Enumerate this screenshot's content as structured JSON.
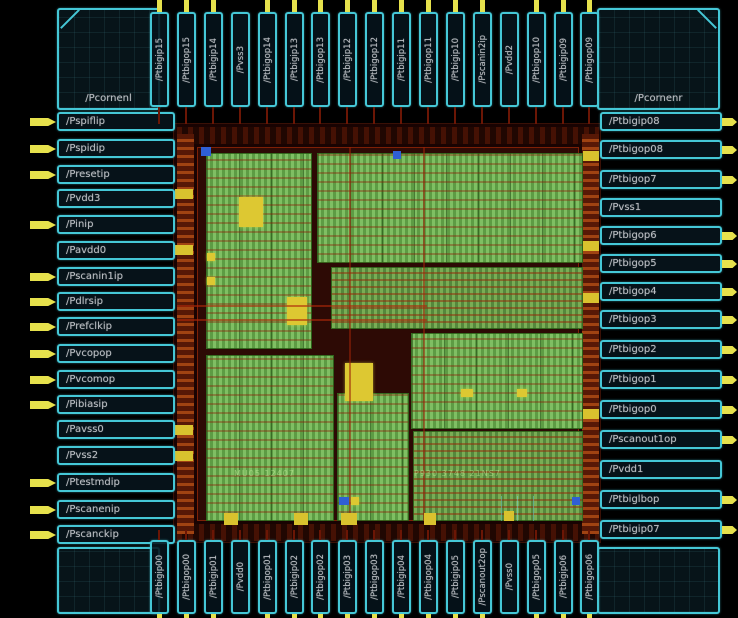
{
  "app": {
    "title": "IC layout viewer - chip pad ring and die"
  },
  "pads": {
    "corner_tl": {
      "label": "/Pcornenl"
    },
    "corner_tr": {
      "label": "/Pcornenr"
    },
    "left": [
      {
        "label": "/Pspiflip",
        "pin": true
      },
      {
        "label": "/Pspidip",
        "pin": true
      },
      {
        "label": "/Presetip",
        "pin": true
      },
      {
        "label": "/Pvdd3",
        "pin": false
      },
      {
        "label": "/Pinip",
        "pin": true
      },
      {
        "label": "/Pavdd0",
        "pin": false
      },
      {
        "label": "/Pscanin1ip",
        "pin": true
      },
      {
        "label": "/Pdlrsip",
        "pin": true
      },
      {
        "label": "/Prefclkip",
        "pin": true
      },
      {
        "label": "/Pvcopop",
        "pin": true
      },
      {
        "label": "/Pvcomop",
        "pin": true
      },
      {
        "label": "/Pibiasip",
        "pin": true
      },
      {
        "label": "/Pavss0",
        "pin": false
      },
      {
        "label": "/Pvss2",
        "pin": false
      },
      {
        "label": "/Ptestmdip",
        "pin": true
      },
      {
        "label": "/Pscanenip",
        "pin": true
      },
      {
        "label": "/Pscanckip",
        "pin": true
      }
    ],
    "right": [
      {
        "label": "/Ptbigip08",
        "pin": true
      },
      {
        "label": "/Ptbigop08",
        "pin": true
      },
      {
        "label": "/Ptbigop7",
        "pin": true
      },
      {
        "label": "/Pvss1",
        "pin": false
      },
      {
        "label": "/Ptbigop6",
        "pin": true
      },
      {
        "label": "/Ptbigop5",
        "pin": true
      },
      {
        "label": "/Ptbigop4",
        "pin": true
      },
      {
        "label": "/Ptbigop3",
        "pin": true
      },
      {
        "label": "/Ptbigop2",
        "pin": true
      },
      {
        "label": "/Ptbigop1",
        "pin": true
      },
      {
        "label": "/Ptbigop0",
        "pin": true
      },
      {
        "label": "/Pscanout1op",
        "pin": true
      },
      {
        "label": "/Pvdd1",
        "pin": false
      },
      {
        "label": "/Ptbiglbop",
        "pin": true
      },
      {
        "label": "/Ptbigip07",
        "pin": true
      }
    ],
    "top": [
      {
        "label": "/Ptbigip15",
        "pin": true
      },
      {
        "label": "/Ptbigop15",
        "pin": true
      },
      {
        "label": "/Ptbigip14",
        "pin": true
      },
      {
        "label": "/Pvss3",
        "pin": false
      },
      {
        "label": "/Ptbigop14",
        "pin": true
      },
      {
        "label": "/Ptbigip13",
        "pin": true
      },
      {
        "label": "/Ptbigop13",
        "pin": true
      },
      {
        "label": "/Ptbigip12",
        "pin": true
      },
      {
        "label": "/Ptbigop12",
        "pin": true
      },
      {
        "label": "/Ptbigip11",
        "pin": true
      },
      {
        "label": "/Ptbigop11",
        "pin": true
      },
      {
        "label": "/Ptbigip10",
        "pin": true
      },
      {
        "label": "/Pscanin2ip",
        "pin": true
      },
      {
        "label": "/Pvdd2",
        "pin": false
      },
      {
        "label": "/Ptbigop10",
        "pin": true
      },
      {
        "label": "/Ptbigip09",
        "pin": true
      },
      {
        "label": "/Ptbigop09",
        "pin": true
      }
    ],
    "bottom": [
      {
        "label": "/Ptbigip00",
        "pin": true
      },
      {
        "label": "/Ptbigop00",
        "pin": true
      },
      {
        "label": "/Ptbigip01",
        "pin": true
      },
      {
        "label": "/Pvdd0",
        "pin": false
      },
      {
        "label": "/Ptbigop01",
        "pin": true
      },
      {
        "label": "/Ptbigip02",
        "pin": true
      },
      {
        "label": "/Ptbigop02",
        "pin": true
      },
      {
        "label": "/Ptbigip03",
        "pin": true
      },
      {
        "label": "/Ptbigop03",
        "pin": true
      },
      {
        "label": "/Ptbigip04",
        "pin": true
      },
      {
        "label": "/Ptbigop04",
        "pin": true
      },
      {
        "label": "/Ptbigip05",
        "pin": true
      },
      {
        "label": "/Pscanout2op",
        "pin": true
      },
      {
        "label": "/Pvss0",
        "pin": false
      },
      {
        "label": "/Ptbigop05",
        "pin": true
      },
      {
        "label": "/Ptbigip06",
        "pin": true
      },
      {
        "label": "/Ptbigop06",
        "pin": true
      }
    ]
  },
  "die": {
    "marking_left": "MU05 12407",
    "marking_right": "P930 3748 21NS7"
  },
  "colors": {
    "pad_outline": "#45c7d6",
    "pin_yellow": "#e6e14c",
    "cell_green": "#7fbf63",
    "ring_red": "#7e2006",
    "label_text": "#b9bdc2"
  }
}
